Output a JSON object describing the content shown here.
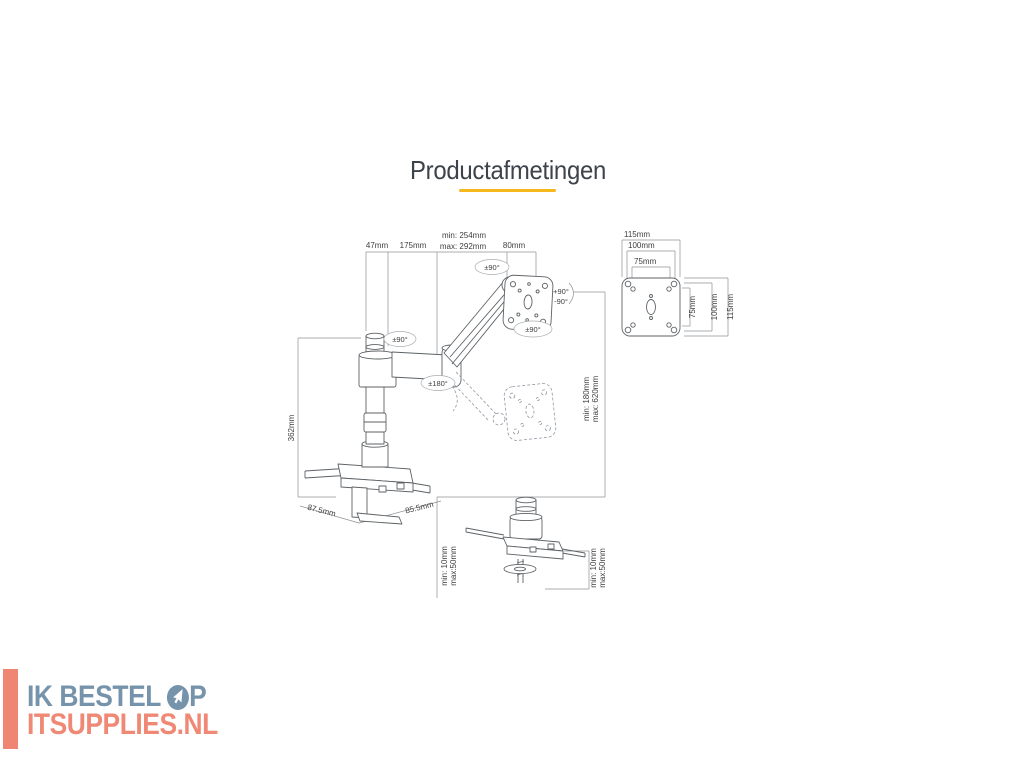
{
  "page": {
    "title": "Productafmetingen"
  },
  "colors": {
    "accent_underline": "#F5B91E",
    "drawing_line": "#5d6266",
    "dimension_line": "#8f9194",
    "logo_blue": "#7693AC",
    "logo_coral": "#EF8875"
  },
  "diagram": {
    "top": {
      "d47": "47mm",
      "d175": "175mm",
      "dmin": "min: 254mm",
      "dmax": "max: 292mm",
      "d80": "80mm"
    },
    "pole_height": "362mm",
    "range": {
      "min": "min: 180mm",
      "max": "max: 620mm"
    },
    "clamp": {
      "left": "87.5mm",
      "right": "85.5mm",
      "tmin": "min: 10mm",
      "tmax": "max:50mm"
    },
    "grommet": {
      "tmin": "min: 10mm",
      "tmax": "max:50mm"
    },
    "rot": {
      "top": "±90°",
      "pole": "±90°",
      "elbow": "±180°",
      "plate": "±90°",
      "tilt_up": "+90°",
      "tilt_down": "-90°"
    },
    "vesa": {
      "h115": "115mm",
      "h100": "100mm",
      "h75": "75mm",
      "v75": "75mm",
      "v100": "100mm",
      "v115": "115mm"
    }
  },
  "logo": {
    "line1": "IK BESTEL",
    "line1_suffix": "P",
    "line2": "ITSUPPLIES.NL"
  }
}
